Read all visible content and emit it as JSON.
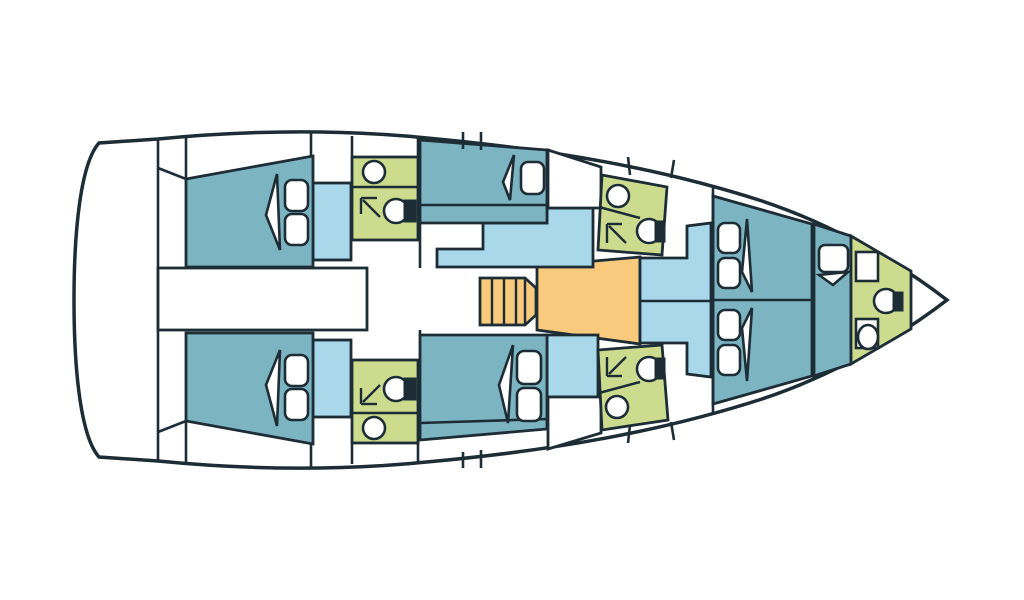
{
  "page": {
    "title": "Sailing yacht interior deck plan",
    "type": "boat-floor-plan",
    "orientation": "bow-right-stern-left"
  },
  "colors": {
    "background": "#ffffff",
    "outline": "#1d2d36",
    "hull": "#ffffff",
    "cabin": "#7db4c1",
    "seating": "#a8d8ea",
    "head": "#cddb8f",
    "galley": "#f9ca7d",
    "fixture": "#ffffff"
  },
  "legend": {
    "cabin": "Sleeping cabins / berths (teal)",
    "seating": "Salon seating, lockers, dinette (light blue)",
    "head": "Heads (bathrooms) with shower (green)",
    "galley": "Galley and companionway steps (orange)",
    "hull": "Deck, walkways and cockpit (white)"
  },
  "rooms": [
    {
      "id": "transom",
      "name": "Transom / swim platform",
      "fixtures": []
    },
    {
      "id": "aft-cabin-port",
      "name": "Aft double cabin (port)",
      "fixtures": [
        "double-berth",
        "pillow",
        "pillow",
        "reading-light"
      ]
    },
    {
      "id": "aft-cabin-starboard",
      "name": "Aft double cabin (starboard)",
      "fixtures": [
        "double-berth",
        "pillow",
        "pillow",
        "reading-light"
      ]
    },
    {
      "id": "head-aft-port",
      "name": "Aft head (port)",
      "fixtures": [
        "sink",
        "shower",
        "toilet"
      ]
    },
    {
      "id": "head-aft-starboard",
      "name": "Aft head (starboard)",
      "fixtures": [
        "sink",
        "shower",
        "toilet"
      ]
    },
    {
      "id": "walkway",
      "name": "Central companionway corridor",
      "fixtures": []
    },
    {
      "id": "mid-cabin-port",
      "name": "Amidships cabin (port)",
      "fixtures": [
        "berth",
        "pillow",
        "reading-light"
      ]
    },
    {
      "id": "mid-cabin-starboard",
      "name": "Amidships cabin (starboard)",
      "fixtures": [
        "berth",
        "pillow",
        "pillow",
        "reading-light"
      ]
    },
    {
      "id": "salon-seating",
      "name": "Salon seating",
      "fixtures": []
    },
    {
      "id": "galley",
      "name": "Galley with companionway steps",
      "fixtures": [
        "steps"
      ]
    },
    {
      "id": "head-forward-port",
      "name": "Forward head (port)",
      "fixtures": [
        "sink",
        "shower",
        "toilet"
      ]
    },
    {
      "id": "head-forward-starboard",
      "name": "Forward head (starboard)",
      "fixtures": [
        "sink",
        "shower",
        "toilet"
      ]
    },
    {
      "id": "forward-dinette",
      "name": "Forward seating / dinette",
      "fixtures": []
    },
    {
      "id": "forward-cabin",
      "name": "Forward V-berth cabin",
      "fixtures": [
        "berth",
        "berth",
        "pillow",
        "pillow",
        "pillow",
        "pillow",
        "reading-light",
        "reading-light"
      ]
    },
    {
      "id": "bow-berth",
      "name": "Bow berth",
      "fixtures": [
        "berth",
        "pillow"
      ]
    },
    {
      "id": "bow-head",
      "name": "Bow head",
      "fixtures": [
        "counter",
        "toilet",
        "counter",
        "sink"
      ]
    }
  ]
}
